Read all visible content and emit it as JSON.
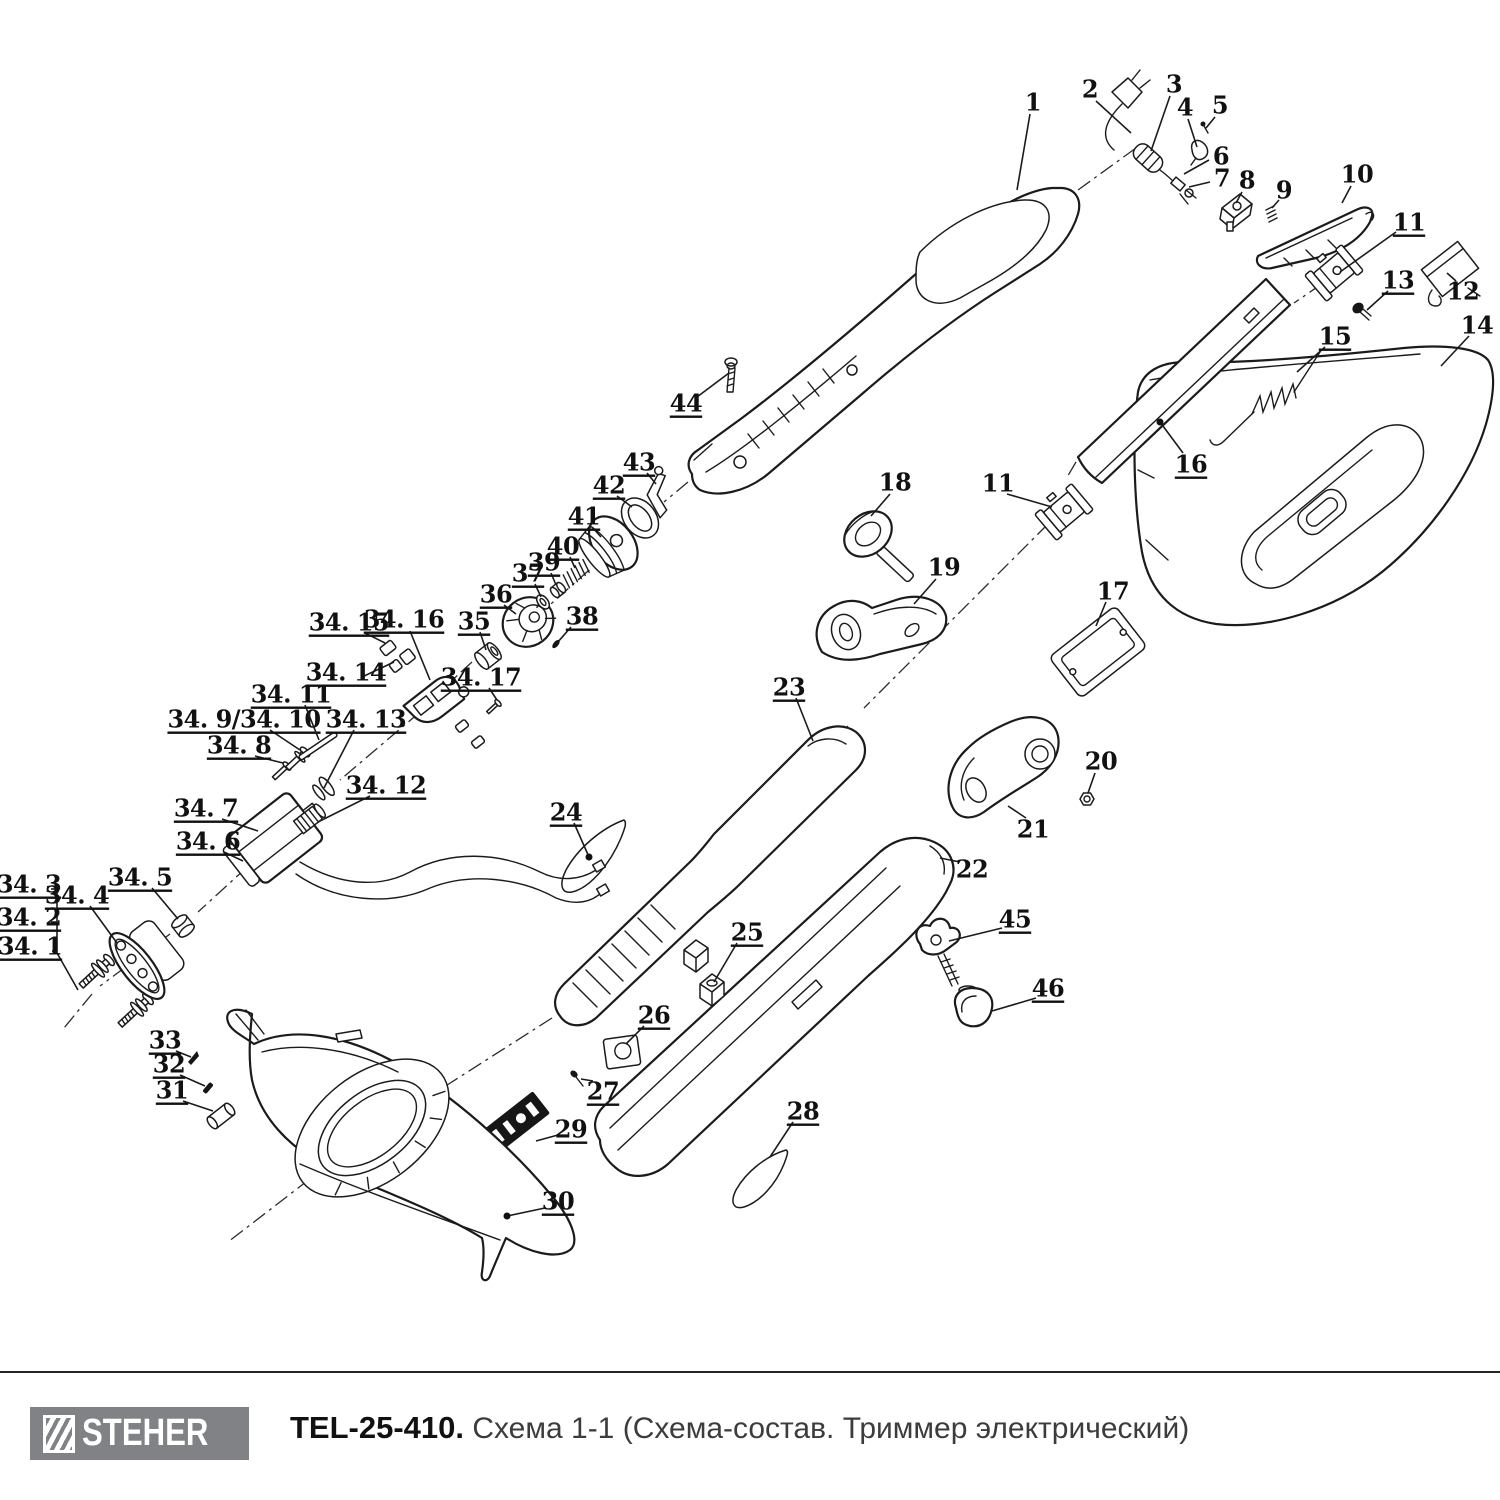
{
  "footer": {
    "brand": "STEHER",
    "title_bold": "TEL-25-410.",
    "title_rest": " Схема 1-1 (Схема-состав. Триммер электрический)",
    "logo_bg": "#808285"
  },
  "diagram": {
    "stroke": "#1b1b1b",
    "callouts": [
      {
        "id": "1",
        "label": "1",
        "x": 1033,
        "y": 102,
        "u": false,
        "leader": [
          [
            1030,
            114
          ],
          [
            1017,
            190
          ]
        ]
      },
      {
        "id": "2",
        "label": "2",
        "x": 1090,
        "y": 89,
        "u": false,
        "leader": [
          [
            1096,
            101
          ],
          [
            1131,
            133
          ]
        ]
      },
      {
        "id": "3",
        "label": "3",
        "x": 1174,
        "y": 84,
        "u": false,
        "leader": [
          [
            1170,
            96
          ],
          [
            1151,
            151
          ]
        ]
      },
      {
        "id": "4",
        "label": "4",
        "x": 1185,
        "y": 107,
        "u": false,
        "leader": [
          [
            1188,
            119
          ],
          [
            1197,
            147
          ]
        ]
      },
      {
        "id": "5",
        "label": "5",
        "x": 1220,
        "y": 105,
        "u": false,
        "leader": [
          [
            1215,
            117
          ],
          [
            1206,
            128
          ]
        ]
      },
      {
        "id": "6",
        "label": "6",
        "x": 1221,
        "y": 156,
        "u": false,
        "leader": [
          [
            1209,
            160
          ],
          [
            1184,
            174
          ]
        ]
      },
      {
        "id": "7",
        "label": "7",
        "x": 1222,
        "y": 178,
        "u": false,
        "leader": [
          [
            1210,
            182
          ],
          [
            1189,
            187
          ]
        ]
      },
      {
        "id": "8",
        "label": "8",
        "x": 1247,
        "y": 180,
        "u": false,
        "leader": [
          [
            1242,
            192
          ],
          [
            1236,
            203
          ]
        ]
      },
      {
        "id": "9",
        "label": "9",
        "x": 1284,
        "y": 190,
        "u": false,
        "leader": [
          [
            1279,
            200
          ],
          [
            1272,
            208
          ]
        ]
      },
      {
        "id": "10",
        "label": "10",
        "x": 1357,
        "y": 174,
        "u": false,
        "leader": [
          [
            1351,
            186
          ],
          [
            1342,
            203
          ]
        ]
      },
      {
        "id": "11a",
        "label": "11",
        "x": 1409,
        "y": 222,
        "u": true,
        "leader": [
          [
            1396,
            232
          ],
          [
            1340,
            272
          ]
        ]
      },
      {
        "id": "12",
        "label": "12",
        "x": 1463,
        "y": 291,
        "u": false,
        "leader": [
          [
            1456,
            281
          ],
          [
            1447,
            273
          ]
        ]
      },
      {
        "id": "13",
        "label": "13",
        "x": 1398,
        "y": 280,
        "u": true,
        "leader": [
          [
            1388,
            291
          ],
          [
            1367,
            310
          ]
        ]
      },
      {
        "id": "14",
        "label": "14",
        "x": 1477,
        "y": 325,
        "u": false,
        "leader": [
          [
            1469,
            336
          ],
          [
            1441,
            366
          ]
        ]
      },
      {
        "id": "15",
        "label": "15",
        "x": 1335,
        "y": 336,
        "u": true,
        "leader": [
          [
            1325,
            347
          ],
          [
            1297,
            372
          ]
        ]
      },
      {
        "id": "16",
        "label": "16",
        "x": 1191,
        "y": 464,
        "u": true,
        "leader": [
          [
            1183,
            453
          ],
          [
            1160,
            422
          ]
        ],
        "dot": true
      },
      {
        "id": "17",
        "label": "17",
        "x": 1113,
        "y": 591,
        "u": false,
        "leader": [
          [
            1106,
            602
          ],
          [
            1096,
            626
          ]
        ]
      },
      {
        "id": "18",
        "label": "18",
        "x": 895,
        "y": 482,
        "u": false,
        "leader": [
          [
            890,
            494
          ],
          [
            871,
            516
          ]
        ]
      },
      {
        "id": "19",
        "label": "19",
        "x": 944,
        "y": 567,
        "u": false,
        "leader": [
          [
            936,
            579
          ],
          [
            914,
            604
          ]
        ]
      },
      {
        "id": "20",
        "label": "20",
        "x": 1101,
        "y": 761,
        "u": false,
        "leader": [
          [
            1095,
            773
          ],
          [
            1088,
            793
          ]
        ]
      },
      {
        "id": "21",
        "label": "21",
        "x": 1033,
        "y": 829,
        "u": false,
        "leader": [
          [
            1026,
            818
          ],
          [
            1008,
            806
          ]
        ]
      },
      {
        "id": "22",
        "label": "22",
        "x": 972,
        "y": 869,
        "u": false,
        "leader": [
          [
            960,
            862
          ],
          [
            940,
            858
          ]
        ]
      },
      {
        "id": "23",
        "label": "23",
        "x": 789,
        "y": 687,
        "u": true,
        "leader": [
          [
            796,
            698
          ],
          [
            813,
            741
          ]
        ]
      },
      {
        "id": "24",
        "label": "24",
        "x": 566,
        "y": 812,
        "u": true,
        "leader": [
          [
            574,
            823
          ],
          [
            589,
            857
          ]
        ],
        "dot": true
      },
      {
        "id": "25",
        "label": "25",
        "x": 747,
        "y": 932,
        "u": true,
        "leader": [
          [
            737,
            943
          ],
          [
            714,
            982
          ]
        ]
      },
      {
        "id": "26",
        "label": "26",
        "x": 654,
        "y": 1015,
        "u": true,
        "leader": [
          [
            644,
            1026
          ],
          [
            626,
            1044
          ]
        ]
      },
      {
        "id": "27",
        "label": "27",
        "x": 603,
        "y": 1091,
        "u": true,
        "leader": [
          [
            593,
            1081
          ],
          [
            581,
            1079
          ]
        ]
      },
      {
        "id": "28",
        "label": "28",
        "x": 803,
        "y": 1111,
        "u": true,
        "leader": [
          [
            793,
            1122
          ],
          [
            770,
            1157
          ]
        ]
      },
      {
        "id": "29",
        "label": "29",
        "x": 571,
        "y": 1129,
        "u": true,
        "leader": [
          [
            558,
            1135
          ],
          [
            536,
            1141
          ]
        ]
      },
      {
        "id": "30",
        "label": "30",
        "x": 558,
        "y": 1201,
        "u": true,
        "leader": [
          [
            545,
            1208
          ],
          [
            507,
            1216
          ]
        ],
        "dot": true
      },
      {
        "id": "31",
        "label": "31",
        "x": 172,
        "y": 1090,
        "u": true,
        "leader": [
          [
            183,
            1101
          ],
          [
            213,
            1111
          ]
        ]
      },
      {
        "id": "32",
        "label": "32",
        "x": 169,
        "y": 1064,
        "u": true,
        "leader": [
          [
            180,
            1075
          ],
          [
            205,
            1086
          ]
        ]
      },
      {
        "id": "33",
        "label": "33",
        "x": 165,
        "y": 1040,
        "u": true,
        "leader": [
          [
            176,
            1051
          ],
          [
            191,
            1057
          ]
        ]
      },
      {
        "id": "34-1",
        "label": "34. 1",
        "x": 30,
        "y": 946,
        "u": true,
        "leader": [
          [
            52,
            951
          ],
          [
            57,
            951
          ]
        ]
      },
      {
        "id": "34-2",
        "label": "34. 2",
        "x": 29,
        "y": 917,
        "u": true,
        "leader": [
          [
            51,
            922
          ],
          [
            57,
            922
          ]
        ]
      },
      {
        "id": "34-3",
        "label": "34. 3",
        "x": 29,
        "y": 884,
        "u": true,
        "leader": [
          [
            51,
            889
          ],
          [
            57,
            889
          ]
        ]
      },
      {
        "id": "34-4",
        "label": "34. 4",
        "x": 77,
        "y": 895,
        "u": true,
        "leader": [
          [
            90,
            906
          ],
          [
            117,
            943
          ]
        ]
      },
      {
        "id": "34-5",
        "label": "34. 5",
        "x": 140,
        "y": 877,
        "u": true,
        "leader": [
          [
            152,
            888
          ],
          [
            178,
            919
          ]
        ]
      },
      {
        "id": "34-6",
        "label": "34. 6",
        "x": 208,
        "y": 841,
        "u": true,
        "leader": [
          [
            224,
            852
          ],
          [
            243,
            861
          ]
        ]
      },
      {
        "id": "34-7",
        "label": "34. 7",
        "x": 206,
        "y": 808,
        "u": true,
        "leader": [
          [
            222,
            819
          ],
          [
            258,
            831
          ]
        ]
      },
      {
        "id": "34-8",
        "label": "34. 8",
        "x": 239,
        "y": 745,
        "u": true,
        "leader": [
          [
            255,
            756
          ],
          [
            283,
            763
          ]
        ]
      },
      {
        "id": "34-9-10",
        "label": "34. 9/34. 10",
        "x": 244,
        "y": 719,
        "u": true,
        "leader": [
          [
            270,
            730
          ],
          [
            300,
            750
          ]
        ]
      },
      {
        "id": "34-11",
        "label": "34. 11",
        "x": 291,
        "y": 694,
        "u": true,
        "leader": [
          [
            305,
            705
          ],
          [
            319,
            740
          ]
        ]
      },
      {
        "id": "34-12",
        "label": "34. 12",
        "x": 386,
        "y": 785,
        "u": true,
        "leader": [
          [
            370,
            796
          ],
          [
            318,
            822
          ]
        ]
      },
      {
        "id": "34-13",
        "label": "34. 13",
        "x": 366,
        "y": 719,
        "u": true,
        "leader": [
          [
            354,
            730
          ],
          [
            324,
            788
          ]
        ]
      },
      {
        "id": "34-14",
        "label": "34. 14",
        "x": 346,
        "y": 672,
        "u": true,
        "leader": [
          [
            362,
            677
          ],
          [
            394,
            662
          ]
        ]
      },
      {
        "id": "34-15",
        "label": "34. 15",
        "x": 349,
        "y": 622,
        "u": true,
        "leader": [
          [
            365,
            633
          ],
          [
            385,
            643
          ]
        ]
      },
      {
        "id": "34-16",
        "label": "34. 16",
        "x": 404,
        "y": 619,
        "u": true,
        "leader": [
          [
            410,
            631
          ],
          [
            430,
            680
          ]
        ]
      },
      {
        "id": "34-17",
        "label": "34. 17",
        "x": 481,
        "y": 677,
        "u": true,
        "leader": [
          [
            489,
            688
          ],
          [
            497,
            700
          ]
        ]
      },
      {
        "id": "35",
        "label": "35",
        "x": 474,
        "y": 621,
        "u": true,
        "leader": [
          [
            480,
            632
          ],
          [
            486,
            650
          ]
        ]
      },
      {
        "id": "36",
        "label": "36",
        "x": 496,
        "y": 594,
        "u": true,
        "leader": [
          [
            504,
            605
          ],
          [
            516,
            614
          ]
        ]
      },
      {
        "id": "37",
        "label": "37",
        "x": 528,
        "y": 573,
        "u": true,
        "leader": [
          [
            535,
            584
          ],
          [
            541,
            597
          ]
        ]
      },
      {
        "id": "38",
        "label": "38",
        "x": 582,
        "y": 616,
        "u": true,
        "leader": [
          [
            571,
            627
          ],
          [
            557,
            643
          ]
        ]
      },
      {
        "id": "39",
        "label": "39",
        "x": 544,
        "y": 562,
        "u": true,
        "leader": [
          [
            551,
            573
          ],
          [
            556,
            585
          ]
        ]
      },
      {
        "id": "40",
        "label": "40",
        "x": 563,
        "y": 546,
        "u": true,
        "leader": [
          [
            570,
            557
          ],
          [
            575,
            568
          ]
        ]
      },
      {
        "id": "41",
        "label": "41",
        "x": 584,
        "y": 516,
        "u": true,
        "leader": [
          [
            592,
            527
          ],
          [
            601,
            537
          ]
        ]
      },
      {
        "id": "42",
        "label": "42",
        "x": 609,
        "y": 485,
        "u": true,
        "leader": [
          [
            617,
            496
          ],
          [
            632,
            507
          ]
        ]
      },
      {
        "id": "43",
        "label": "43",
        "x": 639,
        "y": 462,
        "u": true,
        "leader": [
          [
            647,
            473
          ],
          [
            656,
            484
          ]
        ]
      },
      {
        "id": "44",
        "label": "44",
        "x": 686,
        "y": 403,
        "u": true,
        "leader": [
          [
            697,
            397
          ],
          [
            729,
            373
          ]
        ]
      },
      {
        "id": "45",
        "label": "45",
        "x": 1015,
        "y": 919,
        "u": true,
        "leader": [
          [
            1002,
            928
          ],
          [
            949,
            941
          ]
        ]
      },
      {
        "id": "46",
        "label": "46",
        "x": 1048,
        "y": 988,
        "u": true,
        "leader": [
          [
            1036,
            998
          ],
          [
            992,
            1011
          ]
        ]
      },
      {
        "id": "11b",
        "label": "11",
        "x": 998,
        "y": 483,
        "u": false,
        "leader": [
          [
            1007,
            494
          ],
          [
            1052,
            507
          ]
        ]
      }
    ],
    "axes": [
      [
        [
          1078,
          190
        ],
        [
          1136,
          148
        ]
      ],
      [
        [
          1345,
          268
        ],
        [
          1294,
          303
        ]
      ],
      [
        [
          1076,
          462
        ],
        [
          1066,
          479
        ]
      ],
      [
        [
          1048,
          524
        ],
        [
          864,
          708
        ]
      ],
      [
        [
          848,
          726
        ],
        [
          566,
          1004
        ]
      ],
      [
        [
          552,
          1018
        ],
        [
          408,
          1110
        ]
      ],
      [
        [
          376,
          1128
        ],
        [
          228,
          1242
        ]
      ],
      [
        [
          688,
          482
        ],
        [
          664,
          502
        ]
      ],
      [
        [
          652,
          514
        ],
        [
          524,
          628
        ]
      ],
      [
        [
          472,
          662
        ],
        [
          448,
          684
        ]
      ],
      [
        [
          420,
          712
        ],
        [
          340,
          780
        ]
      ],
      [
        [
          268,
          848
        ],
        [
          198,
          912
        ]
      ],
      [
        [
          170,
          934
        ],
        [
          100,
          986
        ]
      ],
      [
        [
          92,
          994
        ],
        [
          64,
          1028
        ]
      ]
    ],
    "extra_lines": [
      [
        [
          57,
          886
        ],
        [
          57,
          953
        ]
      ],
      [
        [
          57,
          953
        ],
        [
          78,
          990
        ]
      ]
    ]
  }
}
